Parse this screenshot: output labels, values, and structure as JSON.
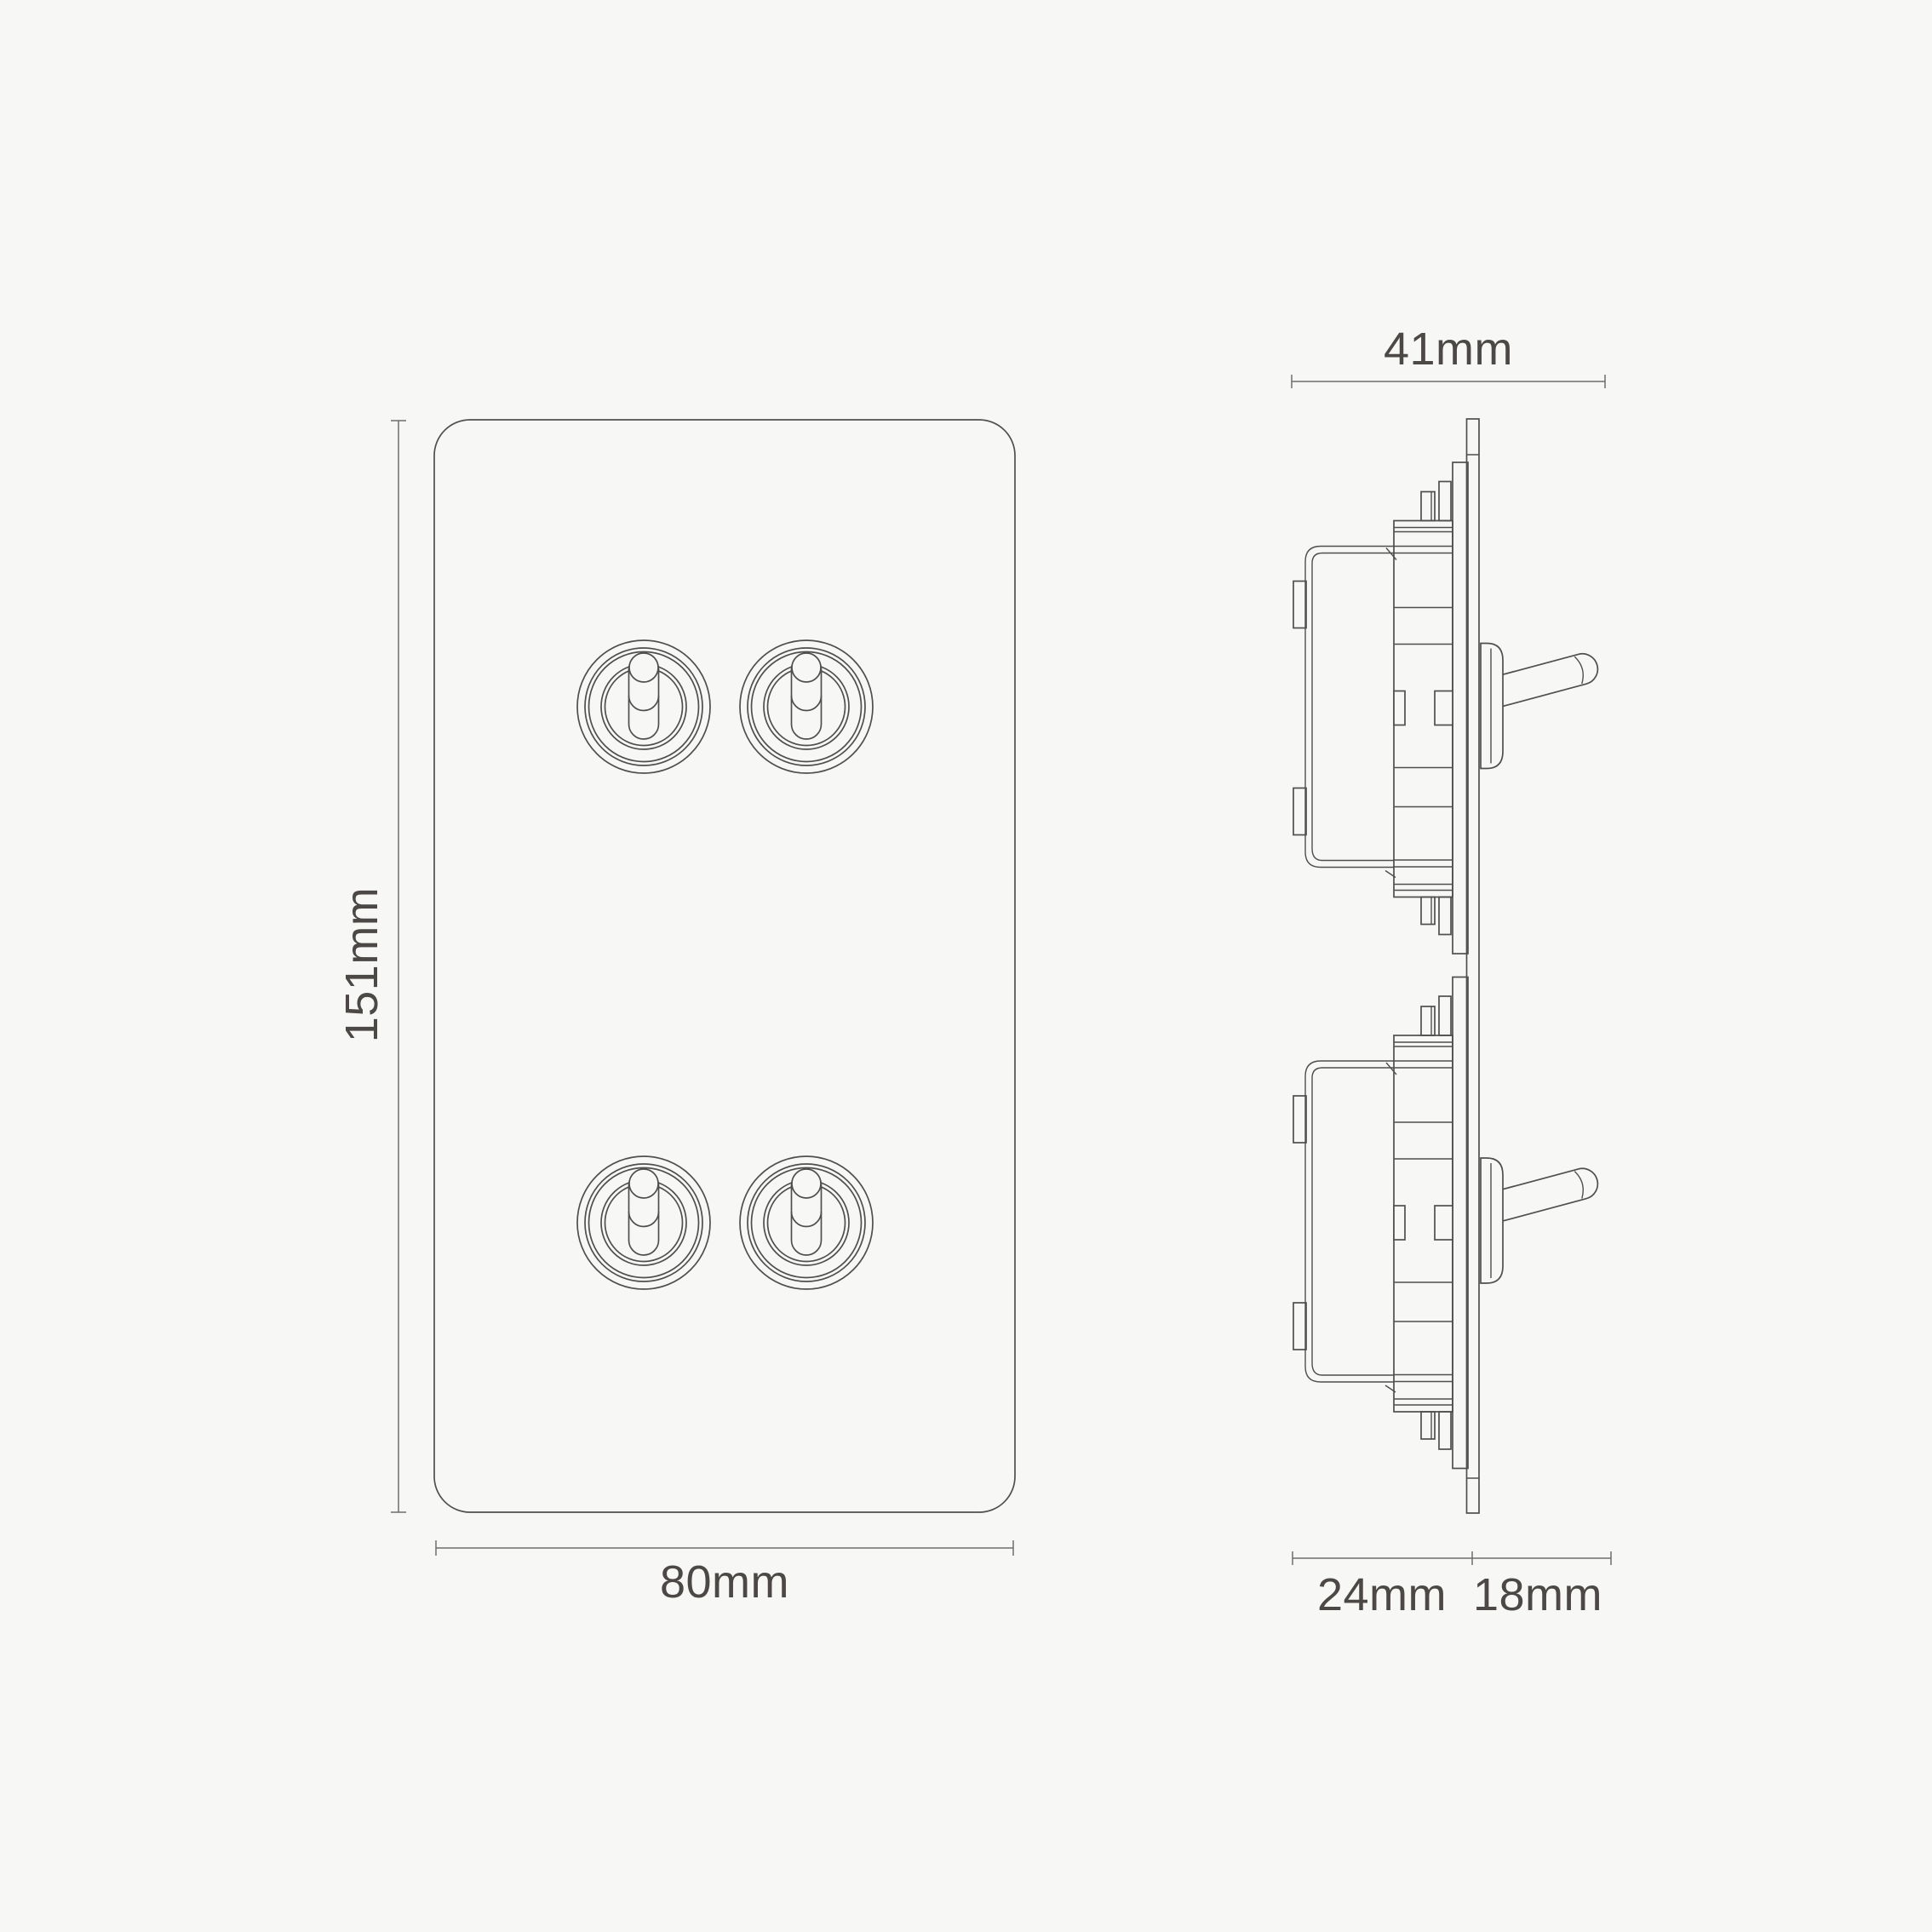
{
  "canvas": {
    "background_color": "#f7f7f5",
    "drawing_line_color": "#4f4f4f",
    "dimension_line_color": "#6e6e6e",
    "label_text_color": "#4b4846"
  },
  "diagram": {
    "front_view": {
      "height_label": "151mm",
      "width_label": "80mm",
      "toggle_count": 4
    },
    "side_view": {
      "overall_depth_label": "41mm",
      "recessed_depth_label": "24mm",
      "projection_depth_label": "18mm",
      "mechanism_count": 2
    }
  }
}
